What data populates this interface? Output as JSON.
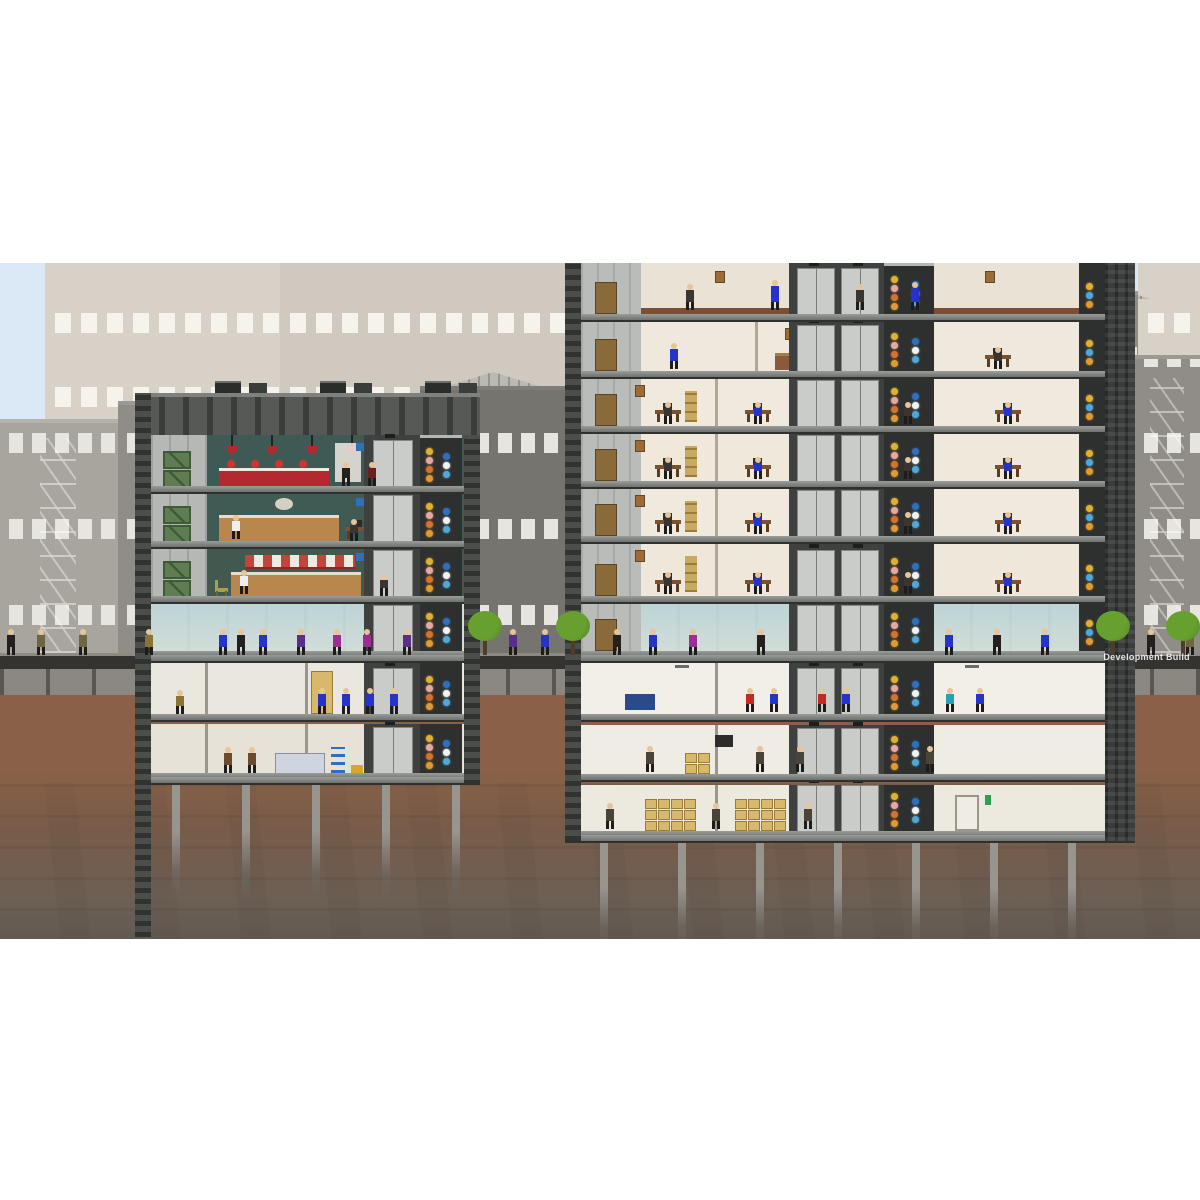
{
  "watermark": {
    "text": "Development Build"
  },
  "scene": {
    "name": "highrise-cross-section",
    "sky_color": "#dbe8f6",
    "letterbox_color": "#ffffff",
    "street_top": "#8e8a82",
    "street_dark": "#35332f",
    "curb_concrete": "#8b8781",
    "dirt_upper": "#8a6148",
    "dirt_mid": "#6b5f55",
    "dirt_lower": "#544f4b",
    "pile_color": "#98948e"
  },
  "background": {
    "far_facade_a": "#d8d1c7",
    "far_facade_b": "#cfc9c0",
    "far_window": "#f6f3ec",
    "mid_facade_a": "#a8a49e",
    "mid_facade_b": "#908d88",
    "mid_facade_dark": "#76746f",
    "mid_window": "#e7e5e0",
    "pediment": "#b9b7b2"
  },
  "left_tower": {
    "label": "restaurant low-rise",
    "steel": "#4b4e4b",
    "service_bay": "#b5b8b4",
    "crate_color": "#5f7d52",
    "roof_color": "#4a4d4a",
    "floors": [
      {
        "id": "bar-floor",
        "label": "cocktail bar",
        "wall": "#3d5a55",
        "accent": "#b4292f"
      },
      {
        "id": "restaurant-floor",
        "label": "restaurant",
        "wall": "#3f5b53",
        "accent": "#b9874d"
      },
      {
        "id": "diner-floor",
        "label": "diner with awning",
        "wall": "#43594f",
        "accent": "#c9423a"
      },
      {
        "id": "lobby-floor",
        "label": "lobby",
        "wall": "#d3dcd8"
      }
    ],
    "basements": [
      {
        "id": "basement-1",
        "label": "maintenance crew room",
        "wall": "#eae7df",
        "crew": "#2633c9"
      },
      {
        "id": "basement-2",
        "label": "workshop storage",
        "wall": "#e6e2d8",
        "crew": "#6b4a2f"
      }
    ]
  },
  "right_tower": {
    "label": "office tower",
    "steel": "#4b4e4b",
    "steel_dark": "#3a3d3b",
    "stair_bay": "#b9bcb8",
    "floors": [
      {
        "id": "office-floor-7",
        "label": "offices (cut at top)",
        "wall": "#e9e2d5"
      },
      {
        "id": "office-floor-6",
        "label": "lounge suite",
        "wall": "#efe9dd"
      },
      {
        "id": "office-floor-5",
        "label": "offices",
        "wall": "#f0eade"
      },
      {
        "id": "office-floor-4",
        "label": "offices",
        "wall": "#efe8db"
      },
      {
        "id": "office-floor-3",
        "label": "offices",
        "wall": "#f0eade"
      },
      {
        "id": "office-floor-2",
        "label": "offices",
        "wall": "#eee7da"
      },
      {
        "id": "lobby-floor",
        "label": "lobby",
        "wall": "#d3dcd8"
      }
    ],
    "basements": [
      {
        "id": "basement-1",
        "label": "break rooms",
        "wall": "#f2efe8"
      },
      {
        "id": "basement-2",
        "label": "workshop",
        "wall": "#efece4"
      },
      {
        "id": "basement-3",
        "label": "storage",
        "wall": "#eceade"
      }
    ]
  },
  "shafts": {
    "elevator_bg": "#3f4140",
    "elevator_door": "#c9ccc8",
    "riser_bg": "#2e302f",
    "riser_cap": "#b4b7b3",
    "lights_warm": [
      "#e09a2f",
      "#d4722c",
      "#e8a7a0",
      "#e0b02f"
    ],
    "lights_cool": [
      "#4ea8d8",
      "#eef3f4",
      "#2f6fbd"
    ],
    "floor_sign": "#2f6fbd"
  },
  "street_life": {
    "tree_canopy": "#67a02e",
    "tree_trunk": "#4f3d2c",
    "plant_pot": "#b05a3a",
    "plant_leaf": "#8a9a3a",
    "chair_color": "#a8a04a",
    "tree_positions": [
      468,
      556,
      1096,
      1166
    ],
    "pedestrians": [
      {
        "x": 6,
        "c": "#23201d"
      },
      {
        "x": 36,
        "c": "#6e6640"
      },
      {
        "x": 78,
        "c": "#6e6640"
      },
      {
        "x": 144,
        "c": "#8a7434"
      },
      {
        "x": 236,
        "c": "#23201d"
      },
      {
        "x": 332,
        "c": "#9c2d93"
      },
      {
        "x": 362,
        "c": "#9c2d93"
      },
      {
        "x": 402,
        "c": "#5b2d86"
      },
      {
        "x": 218,
        "c": "#2633c9"
      },
      {
        "x": 258,
        "c": "#2633c9"
      },
      {
        "x": 296,
        "c": "#5b2d86"
      },
      {
        "x": 508,
        "c": "#5b2d86"
      },
      {
        "x": 540,
        "c": "#2633c9"
      },
      {
        "x": 612,
        "c": "#23201d"
      },
      {
        "x": 648,
        "c": "#2633c9"
      },
      {
        "x": 688,
        "c": "#9c2d93"
      },
      {
        "x": 756,
        "c": "#23201d"
      },
      {
        "x": 944,
        "c": "#2633c9"
      },
      {
        "x": 992,
        "c": "#23201d"
      },
      {
        "x": 1040,
        "c": "#2633c9"
      },
      {
        "x": 1146,
        "c": "#23201d"
      },
      {
        "x": 1185,
        "c": "#6e6640"
      }
    ]
  },
  "people_colors": {
    "skin": "#e6c49c",
    "worker_blue": "#2633c9",
    "worker_brown": "#6b4a2f",
    "office_silhouette": "#3a3530",
    "red_figure": "#c52a22",
    "cyan_figure": "#2aa0b4"
  }
}
